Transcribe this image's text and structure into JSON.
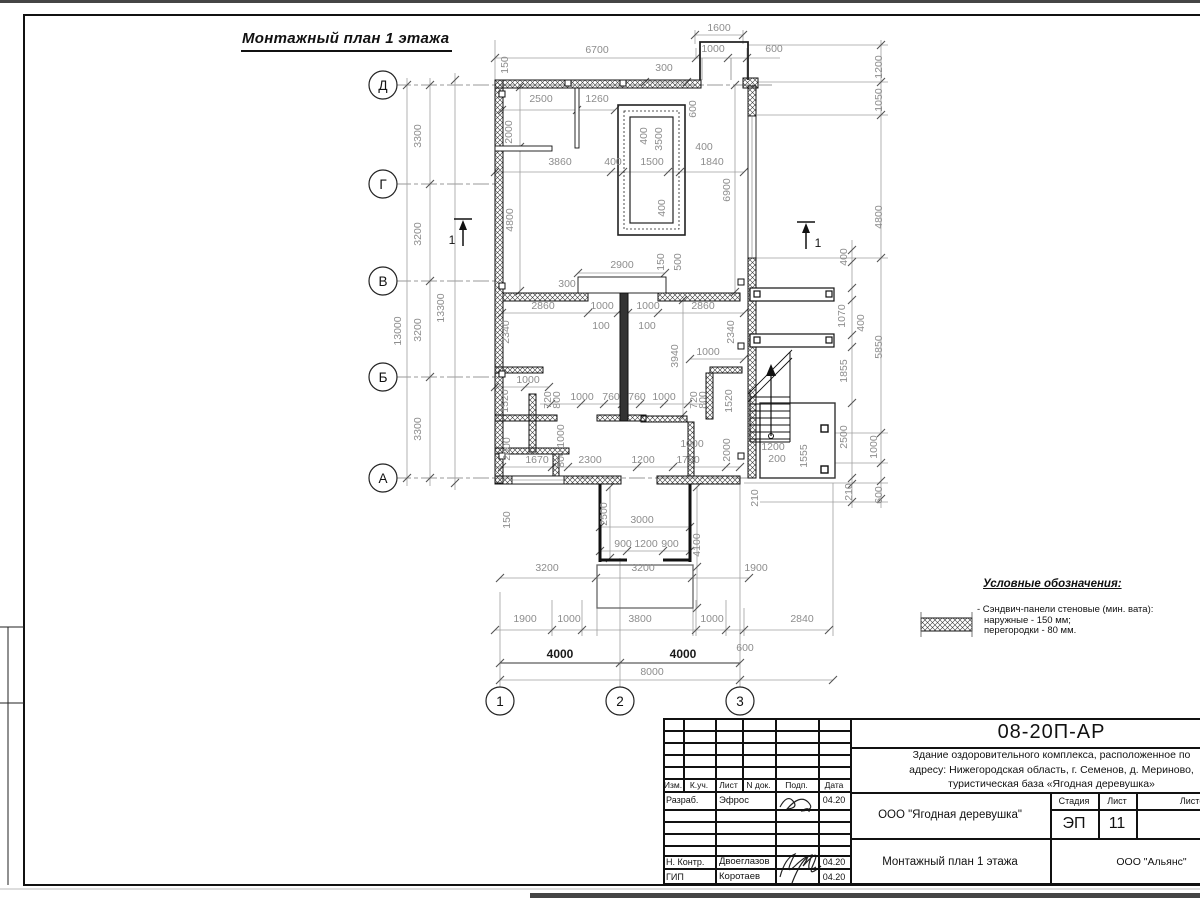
{
  "page": {
    "heading": "Монтажный план 1 этажа"
  },
  "plan": {
    "axis_rows": [
      "Д",
      "Г",
      "В",
      "Б",
      "А"
    ],
    "axis_cols": [
      "1",
      "2",
      "3"
    ],
    "section_marker": "1",
    "labels": [
      [
        "Д",
        383,
        90,
        0,
        "axis"
      ],
      [
        "Г",
        383,
        189,
        0,
        "axis"
      ],
      [
        "В",
        383,
        286,
        0,
        "axis"
      ],
      [
        "Б",
        383,
        382,
        0,
        "axis"
      ],
      [
        "А",
        383,
        483,
        0,
        "axis"
      ],
      [
        "1",
        500,
        706,
        0,
        "axis"
      ],
      [
        "2",
        620,
        706,
        0,
        "axis"
      ],
      [
        "3",
        740,
        706,
        0,
        "axis"
      ],
      [
        "1",
        452,
        244,
        0,
        "marker"
      ],
      [
        "1",
        818,
        247,
        0,
        "marker"
      ],
      [
        "1600",
        719,
        31
      ],
      [
        "6700",
        597,
        53
      ],
      [
        "1000",
        713,
        52
      ],
      [
        "600",
        774,
        52
      ],
      [
        "300",
        664,
        71
      ],
      [
        "2500",
        541,
        102
      ],
      [
        "1260",
        597,
        102
      ],
      [
        "150",
        508,
        65,
        -90
      ],
      [
        "2000",
        512,
        132,
        -90
      ],
      [
        "600",
        696,
        109,
        -90
      ],
      [
        "1200",
        882,
        67,
        -90
      ],
      [
        "1050",
        882,
        100,
        -90
      ],
      [
        "400",
        647,
        136,
        -90
      ],
      [
        "3500",
        662,
        139,
        -90
      ],
      [
        "400",
        704,
        150
      ],
      [
        "3860",
        560,
        165
      ],
      [
        "400",
        613,
        165
      ],
      [
        "1500",
        652,
        165
      ],
      [
        "1840",
        712,
        165
      ],
      [
        "6900",
        730,
        190,
        -90
      ],
      [
        "4800",
        882,
        217,
        -90
      ],
      [
        "4800",
        513,
        220,
        -90
      ],
      [
        "400",
        665,
        208,
        -90
      ],
      [
        "2900",
        622,
        268
      ],
      [
        "300",
        567,
        287
      ],
      [
        "150",
        664,
        262,
        -90
      ],
      [
        "500",
        681,
        262,
        -90
      ],
      [
        "2860",
        543,
        309
      ],
      [
        "1000",
        602,
        309
      ],
      [
        "1000",
        648,
        309
      ],
      [
        "2860",
        703,
        309
      ],
      [
        "100",
        601,
        329
      ],
      [
        "100",
        647,
        329
      ],
      [
        "2340",
        509,
        332,
        -90
      ],
      [
        "2340",
        734,
        332,
        -90
      ],
      [
        "400",
        847,
        257,
        -90
      ],
      [
        "1070",
        845,
        316,
        -90
      ],
      [
        "400",
        864,
        323,
        -90
      ],
      [
        "5850",
        882,
        347,
        -90
      ],
      [
        "1855",
        847,
        371,
        -90
      ],
      [
        "3940",
        678,
        356,
        -90
      ],
      [
        "1000",
        708,
        355
      ],
      [
        "1000",
        528,
        383
      ],
      [
        "720",
        551,
        400,
        -90
      ],
      [
        "800",
        560,
        400,
        -90
      ],
      [
        "1000",
        582,
        400
      ],
      [
        "760",
        611,
        400
      ],
      [
        "760",
        637,
        400
      ],
      [
        "1000",
        664,
        400
      ],
      [
        "720",
        697,
        400,
        -90
      ],
      [
        "800",
        706,
        400,
        -90
      ],
      [
        "1520",
        508,
        401,
        -90
      ],
      [
        "1520",
        732,
        401,
        -90
      ],
      [
        "2000",
        510,
        449,
        -90
      ],
      [
        "1670",
        537,
        463
      ],
      [
        "1000",
        564,
        436,
        -90
      ],
      [
        "800",
        564,
        459,
        -90
      ],
      [
        "2300",
        590,
        463
      ],
      [
        "1200",
        643,
        463
      ],
      [
        "1750",
        688,
        463
      ],
      [
        "1000",
        692,
        447
      ],
      [
        "2000",
        730,
        450,
        -90
      ],
      [
        "1200",
        773,
        450
      ],
      [
        "200",
        777,
        462
      ],
      [
        "1555",
        807,
        456,
        -90
      ],
      [
        "2500",
        847,
        437,
        -90
      ],
      [
        "1000",
        877,
        447,
        -90
      ],
      [
        "150",
        510,
        520,
        -90
      ],
      [
        "2500",
        607,
        514,
        -90
      ],
      [
        "3000",
        642,
        523
      ],
      [
        "900",
        623,
        547
      ],
      [
        "1200",
        646,
        547
      ],
      [
        "900",
        670,
        547
      ],
      [
        "4100",
        700,
        545,
        -90
      ],
      [
        "210",
        758,
        498,
        -90
      ],
      [
        "210",
        852,
        492,
        -90
      ],
      [
        "600",
        882,
        495,
        -90
      ],
      [
        "3200",
        547,
        571
      ],
      [
        "3200",
        643,
        571
      ],
      [
        "1900",
        756,
        571
      ],
      [
        "1900",
        525,
        622
      ],
      [
        "1000",
        569,
        622
      ],
      [
        "3800",
        640,
        622
      ],
      [
        "1000",
        712,
        622
      ],
      [
        "2840",
        802,
        622
      ],
      [
        "600",
        745,
        651
      ],
      [
        "4000",
        560,
        658,
        0,
        "dark"
      ],
      [
        "4000",
        683,
        658,
        0,
        "dark"
      ],
      [
        "8000",
        652,
        675
      ],
      [
        "3300",
        421,
        136,
        -90
      ],
      [
        "3200",
        421,
        234,
        -90
      ],
      [
        "3200",
        421,
        330,
        -90
      ],
      [
        "3300",
        421,
        429,
        -90
      ],
      [
        "13000",
        401,
        331,
        -90
      ],
      [
        "13300",
        444,
        308,
        -90
      ]
    ]
  },
  "legend": {
    "title": "Условные обозначения:",
    "symbol": "crosshatch-sandwich-panel",
    "item_lines": [
      "- Сэндвич-панели стеновые (мин. вата):",
      "наружные - 150 мм;",
      "перегородки - 80 мм."
    ]
  },
  "title_block": {
    "doc_number": "08-20П-АР",
    "description_lines": [
      "Здание оздоровительного комплекса, расположенное по",
      "адресу: Нижегородская область, г. Семенов, д. Мериново,",
      "туристическая база «Ягодная деревушка»"
    ],
    "columns": [
      "Изм.",
      "К.уч.",
      "Лист",
      "N док.",
      "Подп.",
      "Дата"
    ],
    "rows": {
      "developer_role": "Разраб.",
      "developer_name": "Эфрос",
      "developer_date": "04.20",
      "ncontrol_role": "Н. Контр.",
      "ncontrol_name": "Двоеглазов",
      "ncontrol_date": "04.20",
      "gip_role": "ГИП",
      "gip_name": "Коротаев",
      "gip_date": "04.20"
    },
    "client_org": "ООО \"Ягодная деревушка\"",
    "stage_label": "Стадия",
    "sheet_label": "Лист",
    "sheets_label": "Листов",
    "stage_value": "ЭП",
    "sheet_value": "11",
    "sheet_title": "Монтажный план 1 этажа",
    "author_org": "ООО \"Альянс\""
  }
}
